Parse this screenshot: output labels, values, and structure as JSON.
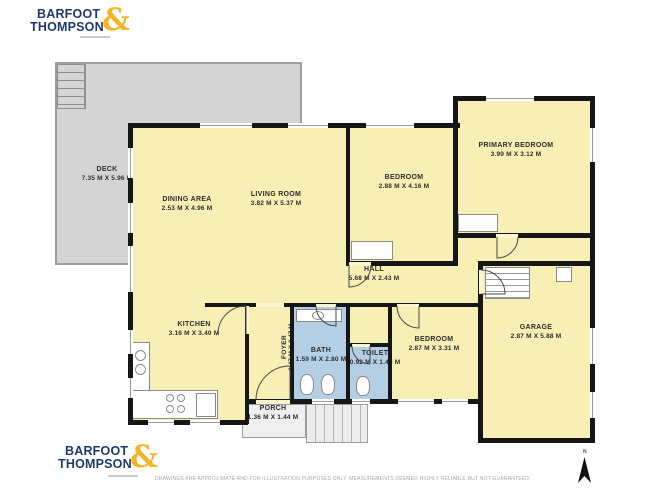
{
  "branding": {
    "name_line1": "BARFOOT",
    "name_line2": "THOMPSON",
    "ampersand": "&",
    "navy": "#1e3a6e",
    "gold": "#f2b626"
  },
  "floorplan": {
    "compass_label": "N",
    "colors": {
      "room_fill": "#f8efb5",
      "wet_room_fill": "#b4cfe3",
      "outdoor_fill": "#d4d4d4",
      "wall": "#161616"
    },
    "rooms": {
      "deck": {
        "name": "DECK",
        "dims": "7.35 M X 5.96 M"
      },
      "dining": {
        "name": "DINING AREA",
        "dims": "2.53 M X 4.96 M"
      },
      "living": {
        "name": "LIVING ROOM",
        "dims": "3.82 M X 5.37 M"
      },
      "bedroom_top": {
        "name": "BEDROOM",
        "dims": "2.88 M X 4.16 M"
      },
      "primary": {
        "name": "PRIMARY BEDROOM",
        "dims": "3.99 M X 3.12 M"
      },
      "hall": {
        "name": "HALL",
        "dims": "5.68 M X 2.43 M"
      },
      "kitchen": {
        "name": "KITCHEN",
        "dims": "3.16 M X 3.40 M"
      },
      "foyer": {
        "name": "FOYER",
        "dims": "1.47 M X 3.47 M"
      },
      "bath": {
        "name": "BATH",
        "dims": "1.59 M X 2.80 M"
      },
      "toilet": {
        "name": "TOILET",
        "dims": "0.92 M X 1.45 M"
      },
      "bedroom_bottom": {
        "name": "BEDROOM",
        "dims": "2.87 M X 3.31 M"
      },
      "garage": {
        "name": "GARAGE",
        "dims": "2.87 M X 5.88 M"
      },
      "porch": {
        "name": "PORCH",
        "dims": "1.36 M X 1.44 M"
      }
    }
  },
  "footer": {
    "disclaimer": "DRAWINGS ARE APPROXIMATE AND FOR ILLUSTRATION PURPOSES ONLY. MEASUREMENTS DEEMED HIGHLY RELIABLE BUT NOT GUARANTEED."
  }
}
